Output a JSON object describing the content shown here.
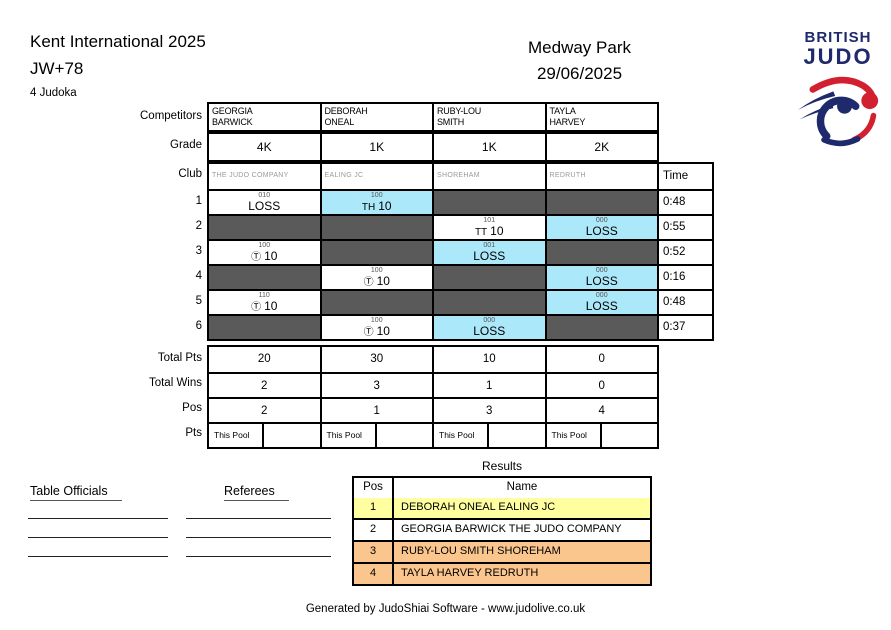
{
  "header": {
    "tournament": "Kent International 2025",
    "category": "JW+78",
    "judoka_count": "4 Judoka",
    "venue": "Medway Park",
    "date": "29/06/2025",
    "logo_line1": "BRITISH",
    "logo_line2": "JUDO"
  },
  "pool": {
    "labels": {
      "competitors": "Competitors",
      "grade": "Grade",
      "club": "Club",
      "time": "Time",
      "total_pts": "Total Pts",
      "total_wins": "Total Wins",
      "pos": "Pos",
      "pts": "Pts"
    },
    "this_pool_label": "This Pool",
    "competitors": [
      {
        "first": "GEORGIA",
        "last": "BARWICK",
        "grade": "4K",
        "club": "THE JUDO COMPANY",
        "total_pts": "20",
        "total_wins": "2",
        "pos": "2"
      },
      {
        "first": "DEBORAH",
        "last": "ONEAL",
        "grade": "1K",
        "club": "EALING JC",
        "total_pts": "30",
        "total_wins": "3",
        "pos": "1"
      },
      {
        "first": "RUBY-LOU",
        "last": "SMITH",
        "grade": "1K",
        "club": "SHOREHAM",
        "total_pts": "10",
        "total_wins": "1",
        "pos": "3"
      },
      {
        "first": "TAYLA",
        "last": "HARVEY",
        "grade": "2K",
        "club": "REDRUTH",
        "total_pts": "0",
        "total_wins": "0",
        "pos": "4"
      }
    ],
    "matches": [
      {
        "number": "1",
        "time": "0:48",
        "cells": [
          {
            "bg": "white",
            "code": "010",
            "value": "LOSS"
          },
          {
            "bg": "blue",
            "code": "100",
            "mark": "TH",
            "value": "10"
          },
          {
            "bg": "gray"
          },
          {
            "bg": "gray"
          }
        ]
      },
      {
        "number": "2",
        "time": "0:55",
        "cells": [
          {
            "bg": "gray"
          },
          {
            "bg": "gray"
          },
          {
            "bg": "white",
            "code": "101",
            "mark": "TT",
            "value": "10"
          },
          {
            "bg": "blue",
            "code": "000",
            "value": "LOSS"
          }
        ]
      },
      {
        "number": "3",
        "time": "0:52",
        "cells": [
          {
            "bg": "white",
            "code": "100",
            "mark": "Ⓣ",
            "value": "10"
          },
          {
            "bg": "gray"
          },
          {
            "bg": "blue",
            "code": "001",
            "value": "LOSS"
          },
          {
            "bg": "gray"
          }
        ]
      },
      {
        "number": "4",
        "time": "0:16",
        "cells": [
          {
            "bg": "gray"
          },
          {
            "bg": "white",
            "code": "100",
            "mark": "Ⓣ",
            "value": "10"
          },
          {
            "bg": "gray"
          },
          {
            "bg": "blue",
            "code": "000",
            "value": "LOSS"
          }
        ]
      },
      {
        "number": "5",
        "time": "0:48",
        "cells": [
          {
            "bg": "white",
            "code": "110",
            "mark": "Ⓣ",
            "value": "10"
          },
          {
            "bg": "gray"
          },
          {
            "bg": "gray"
          },
          {
            "bg": "blue",
            "code": "000",
            "value": "LOSS"
          }
        ]
      },
      {
        "number": "6",
        "time": "0:37",
        "cells": [
          {
            "bg": "gray"
          },
          {
            "bg": "white",
            "code": "100",
            "mark": "Ⓣ",
            "value": "10"
          },
          {
            "bg": "blue",
            "code": "000",
            "value": "LOSS"
          },
          {
            "bg": "gray"
          }
        ]
      }
    ]
  },
  "results": {
    "title": "Results",
    "headers": [
      "Pos",
      "Name"
    ],
    "rows": [
      {
        "pos": "1",
        "name": "DEBORAH ONEAL EALING JC",
        "bg": "#ffffa0"
      },
      {
        "pos": "2",
        "name": "GEORGIA BARWICK THE JUDO COMPANY",
        "bg": "#ffffff"
      },
      {
        "pos": "3",
        "name": "RUBY-LOU SMITH SHOREHAM",
        "bg": "#fbc68d"
      },
      {
        "pos": "4",
        "name": "TAYLA HARVEY  REDRUTH",
        "bg": "#fbc68d"
      }
    ]
  },
  "officials": {
    "table_officials_label": "Table Officials",
    "referees_label": "Referees",
    "signature_lines": 3
  },
  "footer": "Generated by JudoShiai Software - www.judolive.co.uk",
  "colors": {
    "navy": "#1e2a6b",
    "red": "#d22030",
    "cell_gray": "#5a5a5a",
    "cell_blue": "#abe8f9",
    "result_first": "#ffffa0",
    "result_third": "#fbc68d"
  }
}
